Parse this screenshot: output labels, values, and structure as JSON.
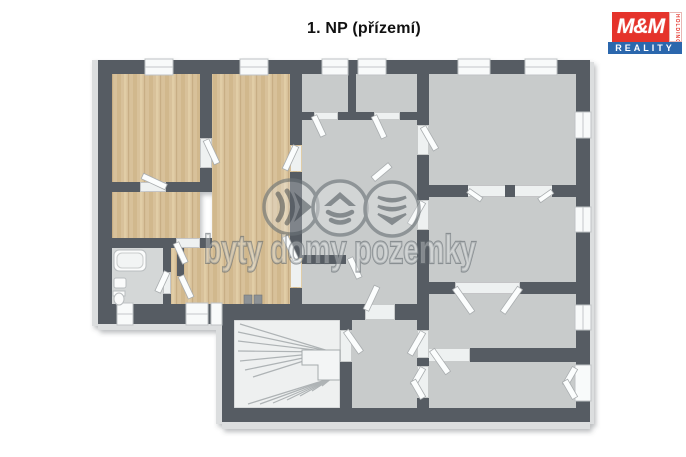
{
  "title": "1. NP (přízemí)",
  "logo": {
    "brand": "M&M",
    "holding": "HOLDING",
    "reality": "REALITY",
    "red": "#e5332b",
    "blue": "#2b67ad"
  },
  "watermark": {
    "text": "byty domy pozemky",
    "icons": [
      "apartments-icon",
      "house-icon",
      "land-icon"
    ],
    "color": "#6c7478"
  },
  "floorplan": {
    "colors": {
      "wall": "#575c63",
      "wood": "#d8c19a",
      "wood_stripe": "#cbb083",
      "floor": "#c8cbcb",
      "bathroom": "#d4d7d7",
      "stairs": "#eef0f0"
    }
  }
}
